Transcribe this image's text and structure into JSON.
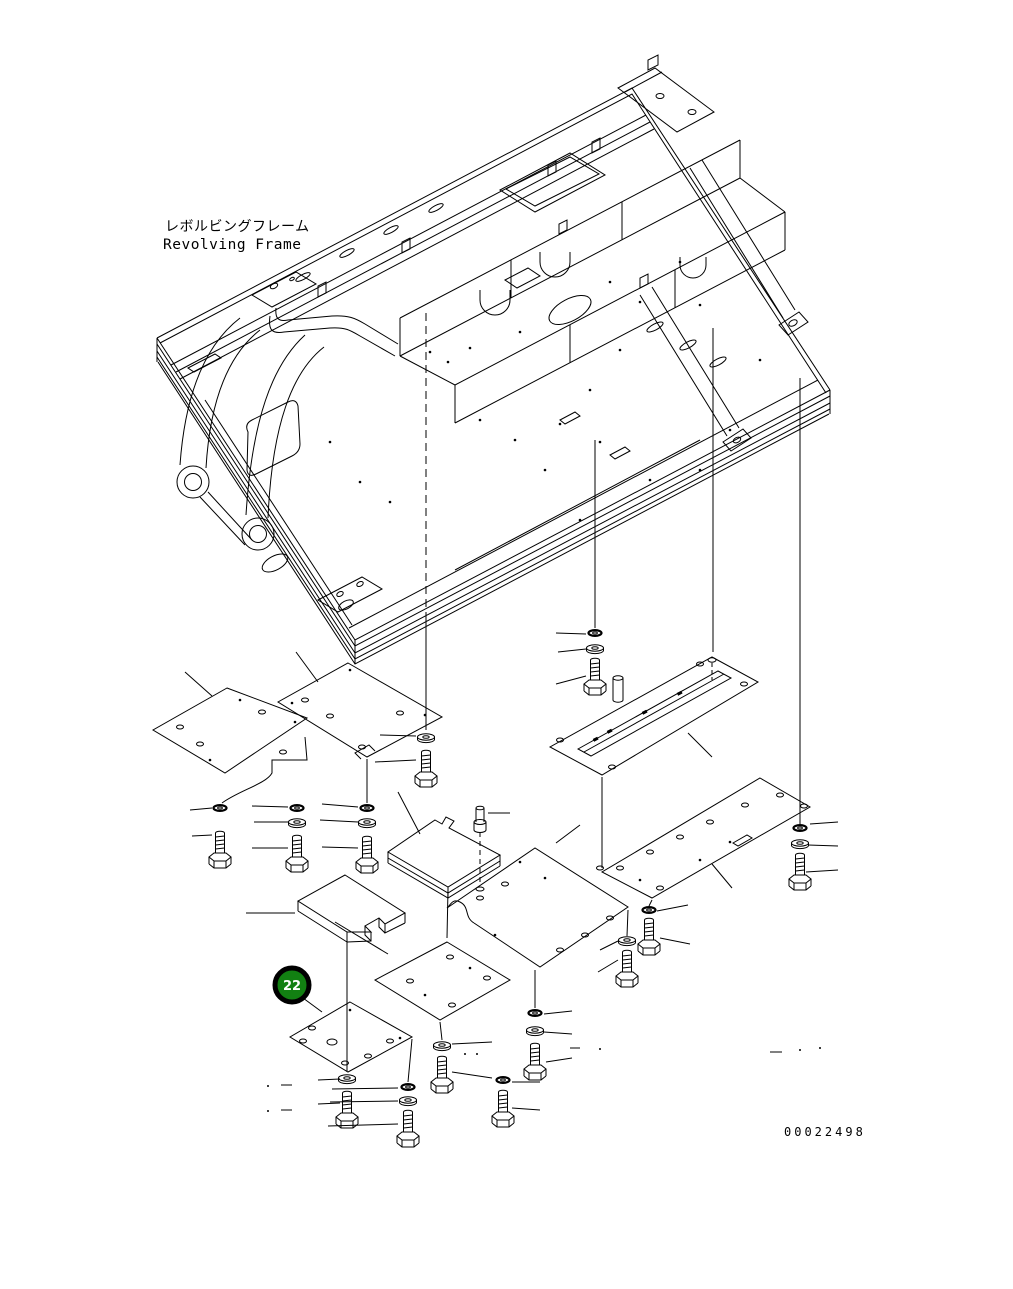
{
  "page": {
    "background": "#ffffff",
    "ink": "#000000"
  },
  "title": {
    "ja": "レボルビングフレーム",
    "en": "Revolving Frame"
  },
  "callout": {
    "number": "22",
    "circle_fill": "#128012",
    "ring_color": "#000000",
    "number_color": "#ffffff"
  },
  "footer": {
    "drawing_number": "00022498"
  }
}
